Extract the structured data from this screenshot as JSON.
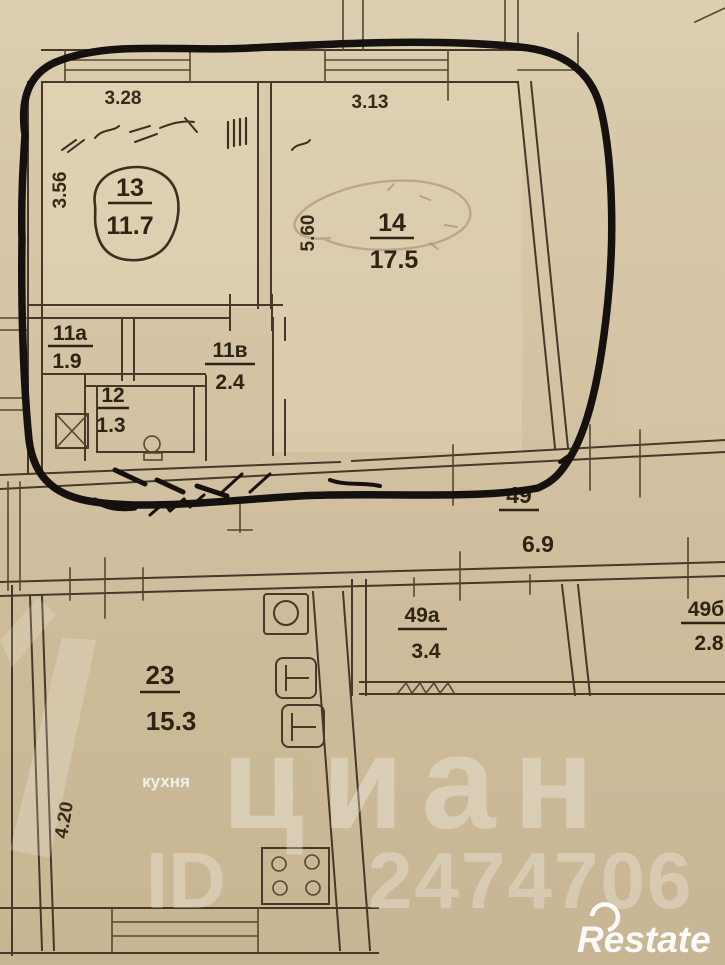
{
  "floorplan": {
    "rooms": [
      {
        "number": "13",
        "area": "11.7"
      },
      {
        "number": "14",
        "area": "17.5"
      },
      {
        "number": "11а",
        "area": "1.9"
      },
      {
        "number": "11в",
        "area": "2.4"
      },
      {
        "number": "12",
        "area": "1.3"
      },
      {
        "number": "49",
        "area": "6.9"
      },
      {
        "number": "49а",
        "area": "3.4"
      },
      {
        "number": "49б",
        "area": "2.8"
      },
      {
        "number": "23",
        "area": "15.3"
      }
    ],
    "kitchen_caption": "кухня",
    "dimensions": {
      "room13_width": "3.28",
      "room13_depth": "3.56",
      "room14_width": "3.13",
      "room14_depth": "5.60",
      "room23_depth": "4.20"
    },
    "icons": [
      "ventilation-shaft-icon",
      "toilet-icon",
      "sink-icon",
      "heater-icon",
      "heater-icon",
      "stove-icon",
      "marker-circle-annotation",
      "pencil-blob-annotation"
    ]
  },
  "watermark": {
    "brand": "циан",
    "id_label": "ID",
    "id_number": "2474706",
    "agency": "Restate"
  },
  "colors": {
    "paper_top": "#dbcdae",
    "paper_bottom": "#c8b593",
    "ink": "#46392a",
    "marker": "#14110e",
    "watermark_white": "#ffffff"
  }
}
